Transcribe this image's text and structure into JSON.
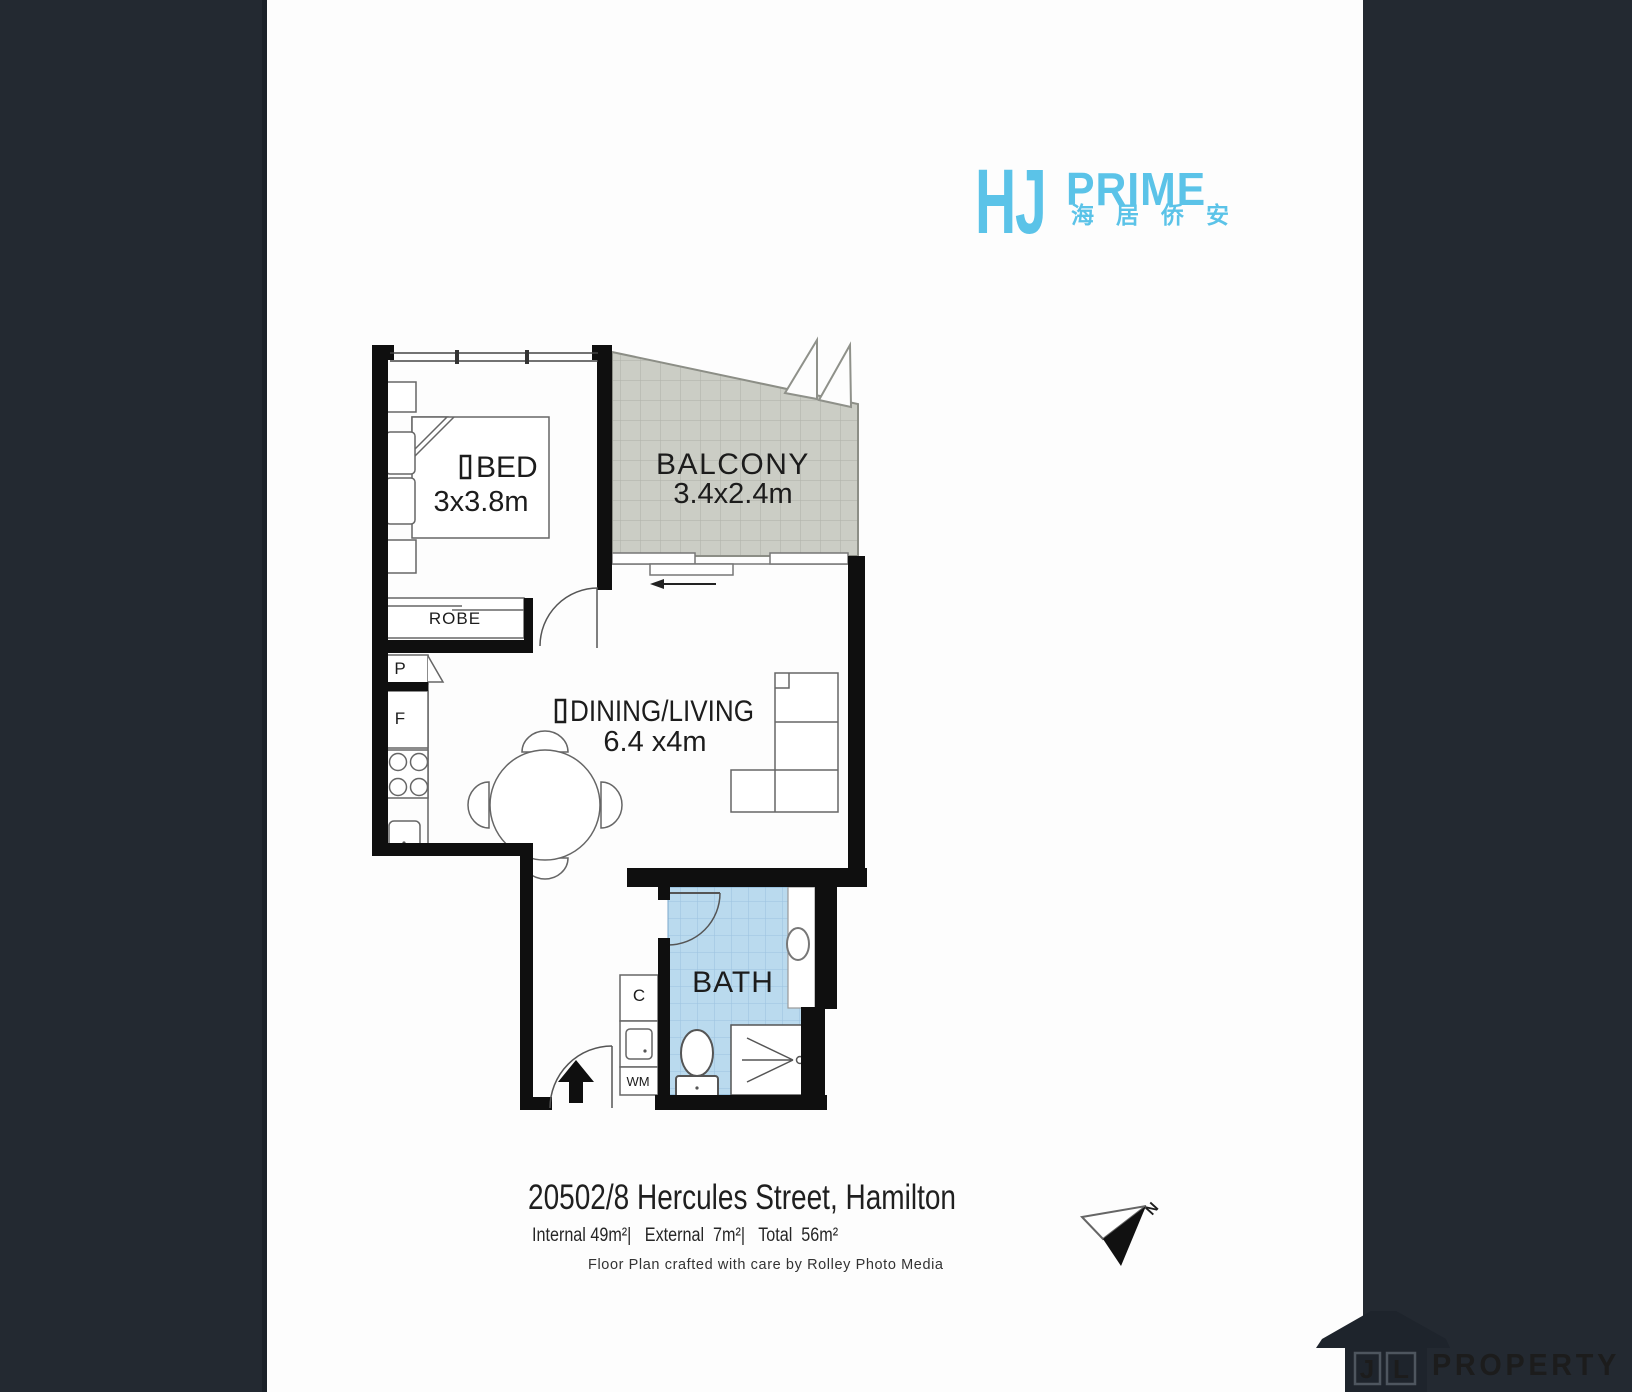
{
  "page": {
    "bg_color": "#232931",
    "paper_color": "#fdfdfd"
  },
  "branding": {
    "hj": "HJ",
    "prime": "PRIME",
    "chinese": "海居侨安",
    "color": "#5bc3e8"
  },
  "floorplan": {
    "rooms": {
      "bed": {
        "label": "BED",
        "dims": "3x3.8m"
      },
      "balcony": {
        "label": "BALCONY",
        "dims": "3.4x2.4m"
      },
      "dining_living": {
        "label": "DINING/LIVING",
        "dims": "6.4 x4m"
      },
      "bath": {
        "label": "BATH"
      },
      "robe": {
        "label": "ROBE"
      }
    },
    "fixtures": {
      "pantry": "P",
      "fridge": "F",
      "cupboard": "C",
      "washer": "WM"
    },
    "compass_north": "N",
    "tile_colors": {
      "balcony": "#cbcdc5",
      "bath": "#badaee"
    }
  },
  "footer": {
    "address": "20502/8 Hercules Street, Hamilton",
    "areas": "Internal 49m²|   External  7m²|   Total  56m²",
    "credit": "Floor Plan crafted with care by Rolley Photo Media"
  },
  "watermark": {
    "j": "J",
    "l": "L",
    "name": "PROPERTY"
  }
}
